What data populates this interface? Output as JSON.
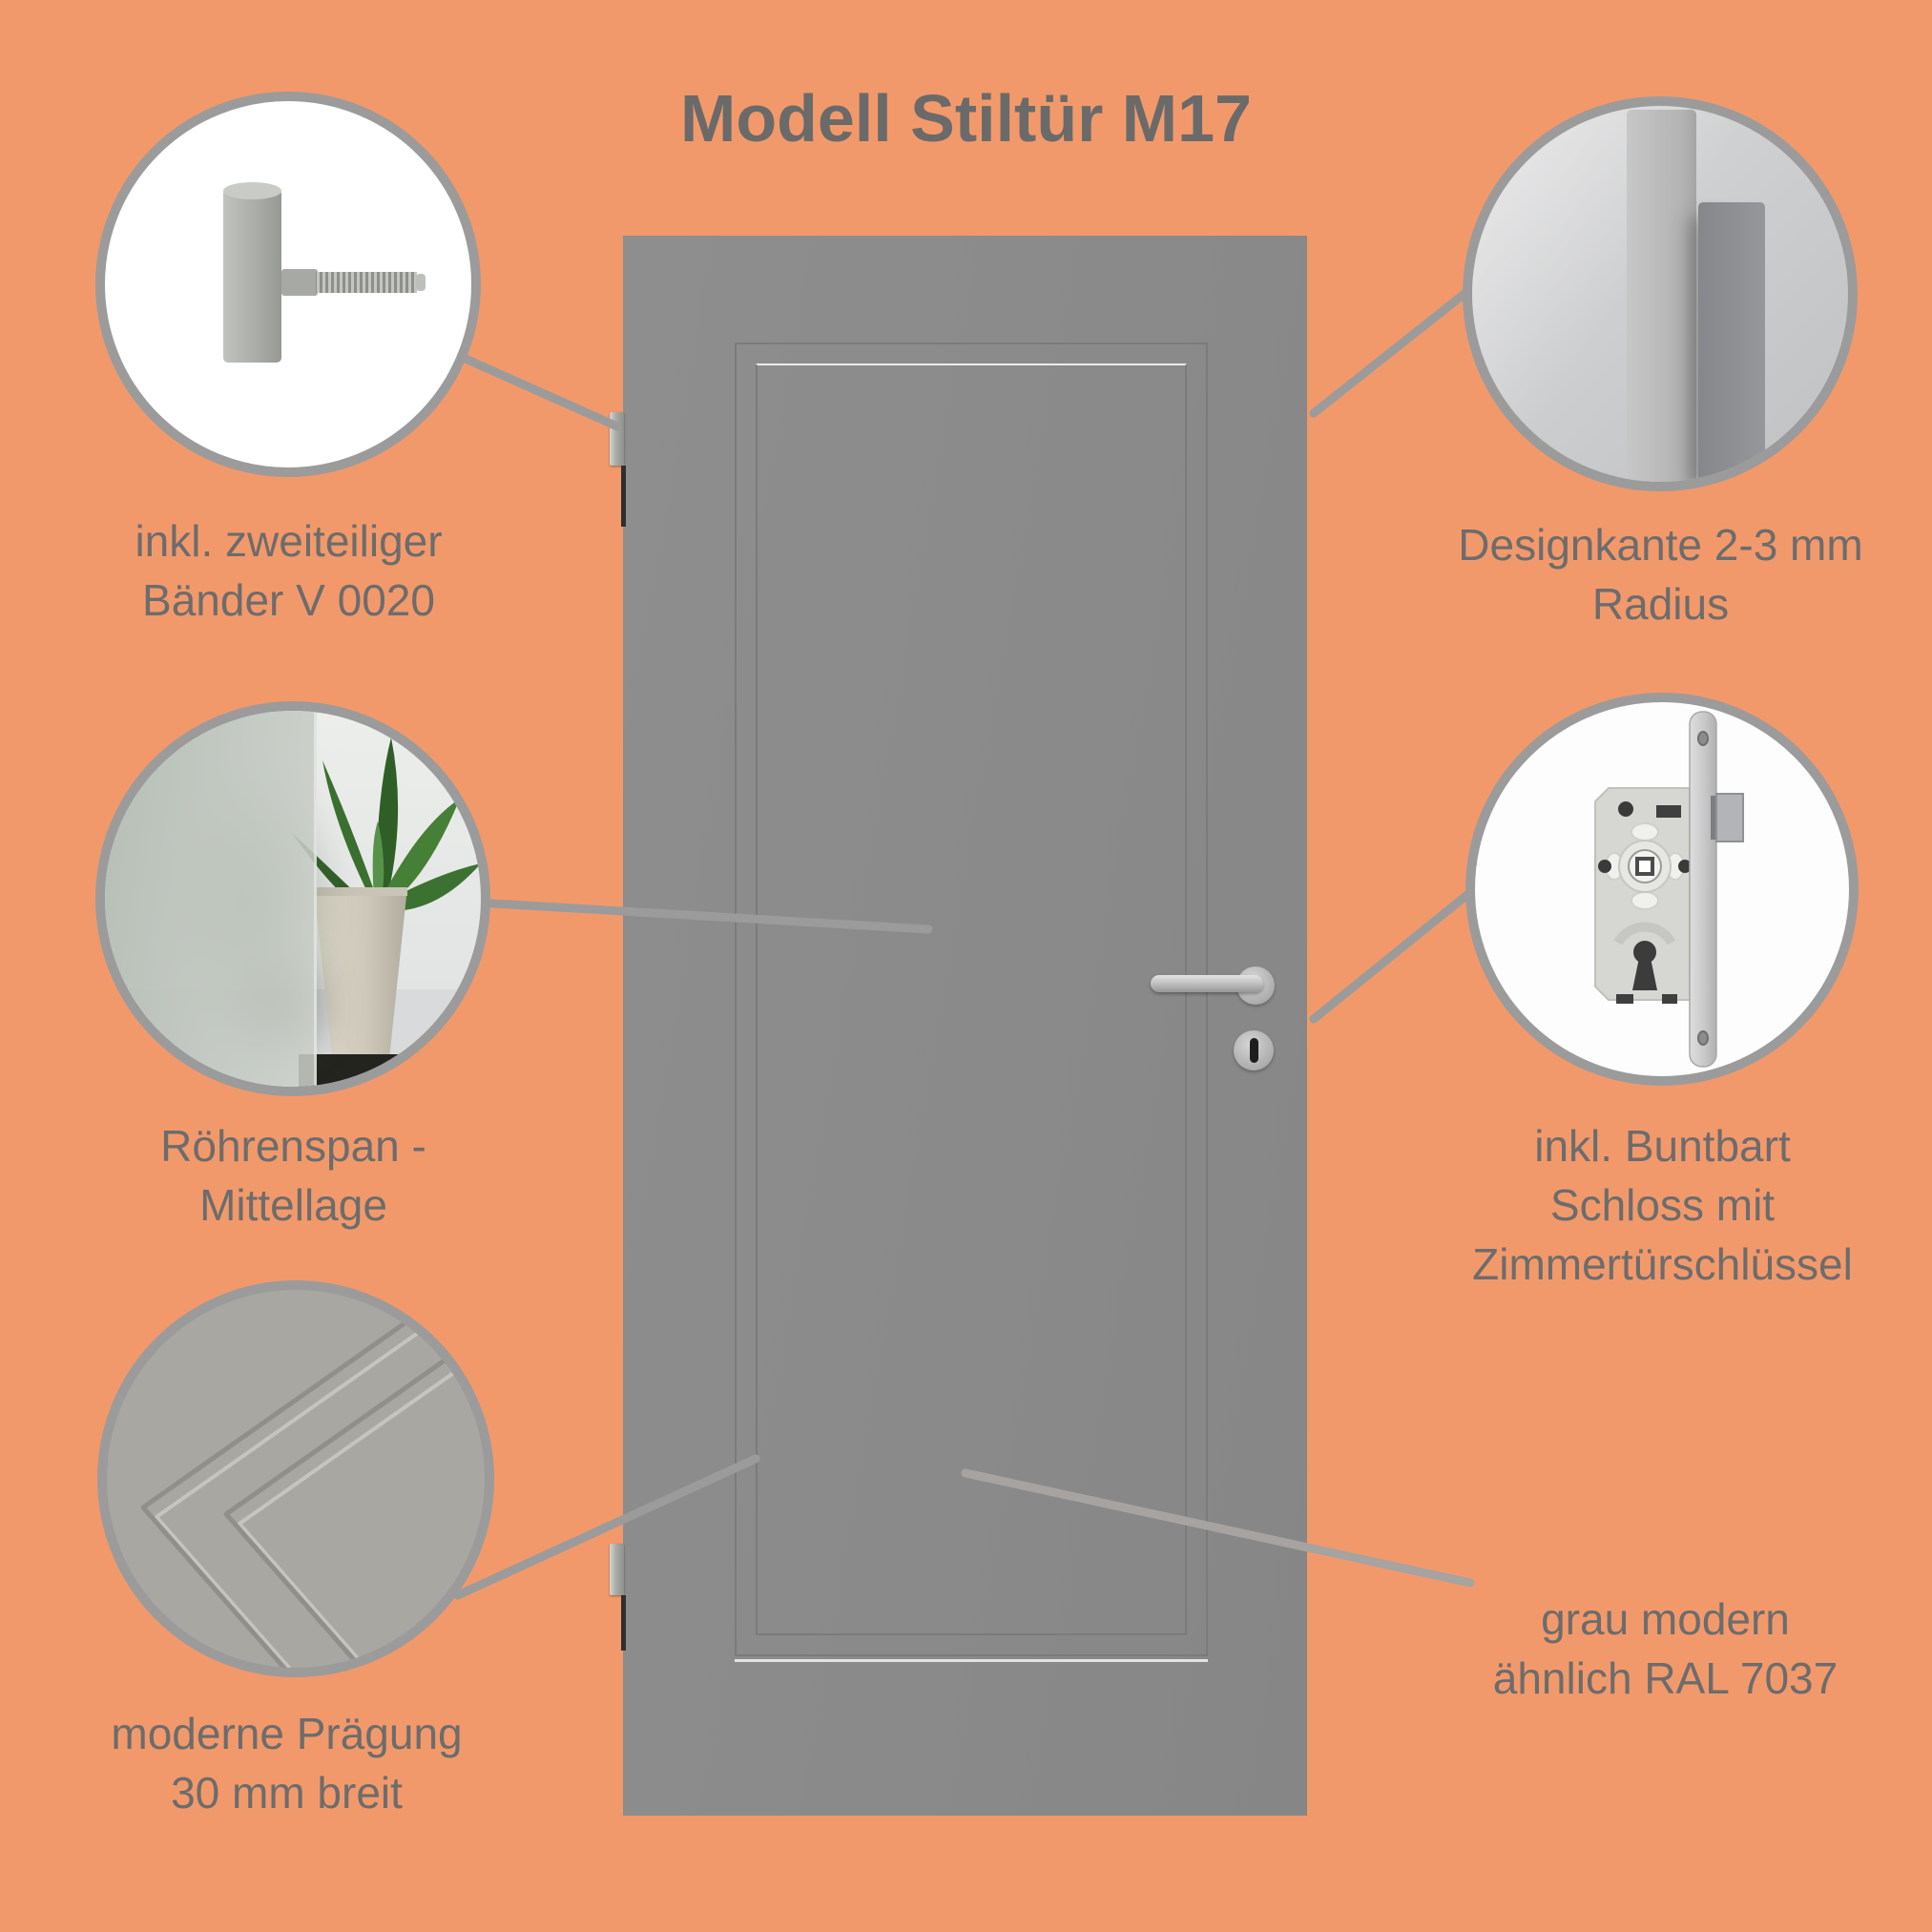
{
  "title": "Modell Stiltür M17",
  "callouts": {
    "hinge": {
      "lines": [
        "inkl. zweiteiliger",
        "Bänder V 0020"
      ]
    },
    "edge": {
      "lines": [
        "Designkante 2-3 mm",
        "Radius"
      ]
    },
    "core": {
      "lines": [
        "Röhrenspan -",
        "Mittellage"
      ]
    },
    "lock": {
      "lines": [
        "inkl. Buntbart",
        "Schloss mit",
        "Zimmertürschlüssel"
      ]
    },
    "emboss": {
      "lines": [
        "moderne Prägung",
        "30 mm breit"
      ]
    }
  },
  "color_note": {
    "lines": [
      "grau modern",
      "ähnlich RAL 7037"
    ]
  },
  "colors": {
    "background": "#F2996B",
    "text": "#6C6C6C",
    "door_gray": "#8B8B8B",
    "line_gray": "#9B9B9B"
  }
}
